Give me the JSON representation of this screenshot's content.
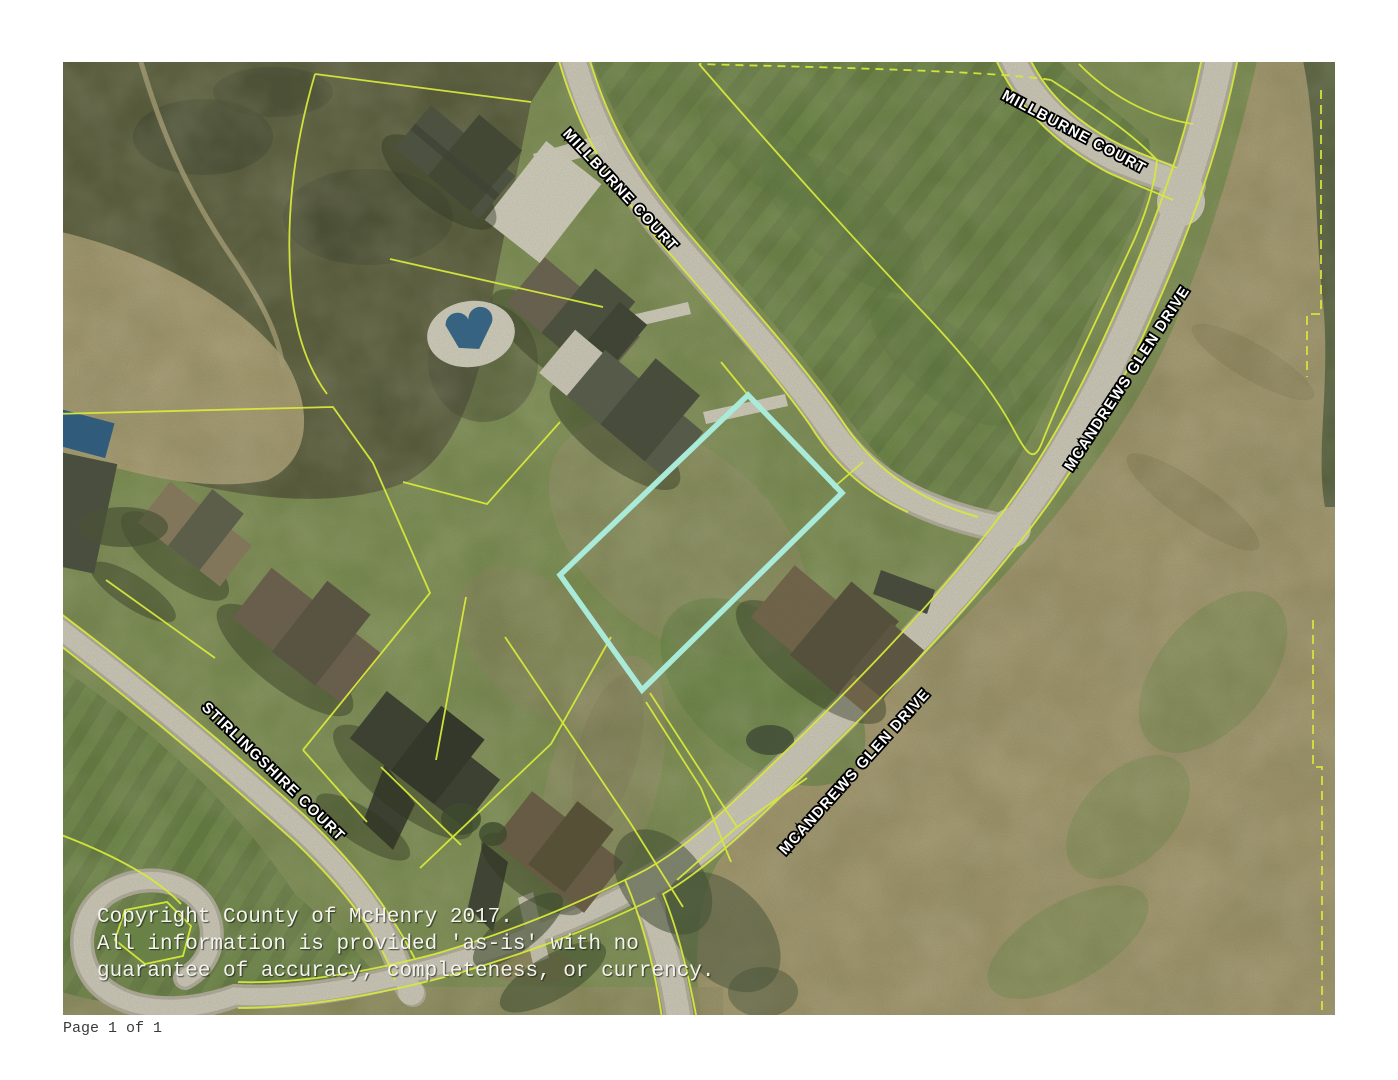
{
  "map": {
    "street_labels": [
      {
        "name": "millburne-court-upper",
        "text": "MILLBURNE COURT"
      },
      {
        "name": "millburne-court-northeast",
        "text": "MILLBURNE COURT"
      },
      {
        "name": "mcandrews-glen-drive-north",
        "text": "MCANDREWS GLEN DRIVE"
      },
      {
        "name": "mcandrews-glen-drive-south",
        "text": "MCANDREWS GLEN DRIVE"
      },
      {
        "name": "stirlingshire-court",
        "text": "STIRLINGSHIRE COURT"
      }
    ],
    "copyright": {
      "line1": "Copyright County of McHenry 2017.",
      "line2": "All information is provided 'as-is' with no",
      "line3": "guarantee of accuracy, completeness, or currency."
    },
    "highlight_parcel": {
      "points": "685,333 779,431 579,628 497,513",
      "color": "#a9ead9"
    },
    "colors": {
      "parcel_line": "#d7e93b",
      "road": "#d3cec1",
      "label_fill": "#ffffff",
      "label_halo": "#000000"
    }
  },
  "footer": {
    "page_label": "Page 1 of 1"
  }
}
